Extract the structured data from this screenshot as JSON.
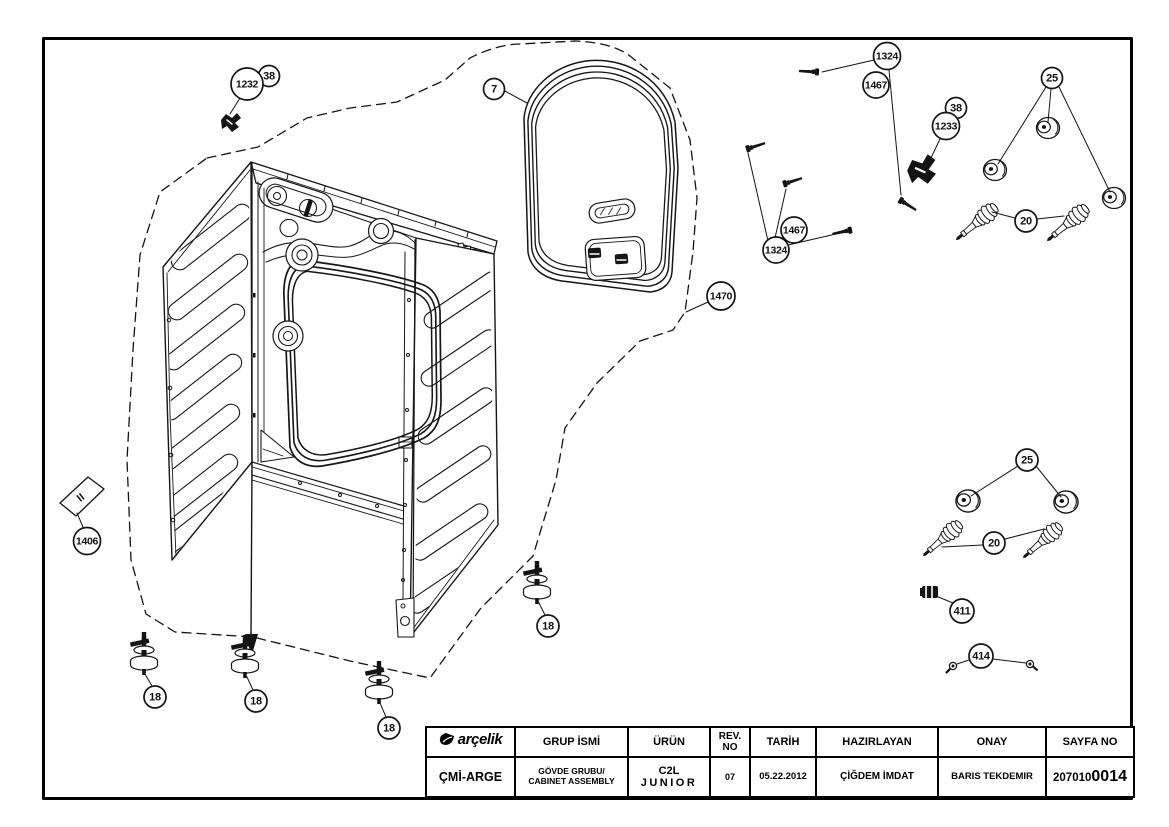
{
  "colors": {
    "ink": "#141414",
    "paper": "#ffffff",
    "border": "#000000"
  },
  "drawing": {
    "plate_mark": "II",
    "callouts": [
      {
        "label": "38",
        "cx": 269,
        "cy": 76,
        "r": 10.5,
        "leaders": []
      },
      {
        "label": "1232",
        "cx": 247,
        "cy": 84,
        "r": 16,
        "leaders": [
          [
            240,
            98,
            230,
            114
          ]
        ]
      },
      {
        "label": "7",
        "cx": 494,
        "cy": 89,
        "r": 10.5,
        "leaders": [
          [
            505,
            91,
            527,
            103
          ]
        ]
      },
      {
        "label": "1324",
        "cx": 887,
        "cy": 56,
        "r": 13.5,
        "leaders": [
          [
            874,
            60,
            822,
            72
          ],
          [
            889,
            70,
            901,
            195
          ]
        ]
      },
      {
        "label": "1467",
        "cx": 876,
        "cy": 85,
        "r": 13,
        "leaders": []
      },
      {
        "label": "38",
        "cx": 956,
        "cy": 108,
        "r": 10.5,
        "leaders": []
      },
      {
        "label": "1233",
        "cx": 946,
        "cy": 126,
        "r": 13.5,
        "leaders": [
          [
            940,
            139,
            930,
            160
          ]
        ]
      },
      {
        "label": "25",
        "cx": 1052,
        "cy": 78,
        "r": 10.5,
        "leaders": [
          [
            1046,
            87,
            998,
            164
          ],
          [
            1051,
            89,
            1048,
            122
          ],
          [
            1059,
            87,
            1110,
            192
          ]
        ]
      },
      {
        "label": "20",
        "cx": 1026,
        "cy": 221,
        "r": 11,
        "leaders": [
          [
            1015,
            218,
            992,
            212
          ],
          [
            1037,
            219,
            1064,
            216
          ]
        ]
      },
      {
        "label": "1470",
        "cx": 721,
        "cy": 296,
        "r": 14,
        "leaders": [
          [
            708,
            302,
            686,
            312
          ]
        ]
      },
      {
        "label": "1467",
        "cx": 794,
        "cy": 230,
        "r": 13,
        "leaders": []
      },
      {
        "label": "1324",
        "cx": 776,
        "cy": 250,
        "r": 13,
        "leaders": [
          [
            768,
            241,
            748,
            153
          ],
          [
            775,
            238,
            786,
            189
          ],
          [
            788,
            245,
            849,
            231
          ]
        ]
      },
      {
        "label": "25",
        "cx": 1027,
        "cy": 460,
        "r": 11,
        "leaders": [
          [
            1018,
            466,
            971,
            496
          ],
          [
            1036,
            466,
            1061,
            497
          ]
        ]
      },
      {
        "label": "20",
        "cx": 994,
        "cy": 543,
        "r": 11,
        "leaders": [
          [
            983,
            545,
            942,
            547
          ],
          [
            1005,
            539,
            1044,
            529
          ]
        ]
      },
      {
        "label": "411",
        "cx": 962,
        "cy": 611,
        "r": 12,
        "leaders": [
          [
            953,
            603,
            936,
            596
          ]
        ]
      },
      {
        "label": "414",
        "cx": 981,
        "cy": 656,
        "r": 12,
        "leaders": [
          [
            969,
            660,
            957,
            664
          ],
          [
            993,
            659,
            1026,
            663
          ]
        ]
      },
      {
        "label": "18",
        "cx": 155,
        "cy": 697,
        "r": 11,
        "leaders": [
          [
            152,
            686,
            145,
            674
          ]
        ]
      },
      {
        "label": "18",
        "cx": 256,
        "cy": 701,
        "r": 11,
        "leaders": [
          [
            253,
            690,
            247,
            677
          ]
        ]
      },
      {
        "label": "18",
        "cx": 389,
        "cy": 728,
        "r": 11,
        "leaders": [
          [
            386,
            717,
            380,
            703
          ]
        ]
      },
      {
        "label": "18",
        "cx": 548,
        "cy": 626,
        "r": 11,
        "leaders": [
          [
            545,
            615,
            539,
            603
          ]
        ]
      },
      {
        "label": "1406",
        "cx": 87,
        "cy": 541,
        "r": 13.5,
        "leaders": [
          [
            83,
            527,
            77,
            513
          ]
        ]
      }
    ]
  },
  "title_block": {
    "brand": "arçelik",
    "org": "ÇMİ-ARGE",
    "group_label": "GRUP İSMİ",
    "group_value_1": "GÖVDE GRUBU/",
    "group_value_2": "CABINET ASSEMBLY",
    "product_label": "ÜRÜN",
    "product_value_1": "C2L",
    "product_value_2": "JUNIOR",
    "rev_label_1": "REV.",
    "rev_label_2": "NO",
    "rev_value": "07",
    "date_label": "TARİH",
    "date_value": "05.22.2012",
    "prepared_label": "HAZIRLAYAN",
    "prepared_value": "ÇİĞDEM İMDAT",
    "approval_label": "ONAY",
    "approval_value": "BARIS TEKDEMIR",
    "page_label": "SAYFA NO",
    "page_prefix": "207010",
    "page_bold": "0014"
  }
}
